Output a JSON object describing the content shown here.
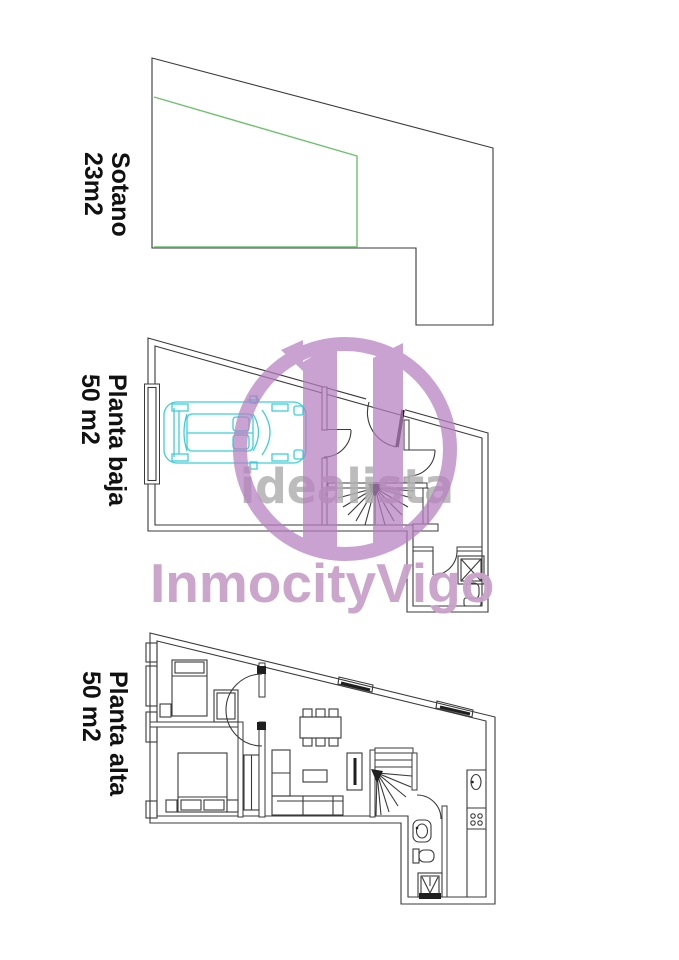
{
  "floors": [
    {
      "id": "sotano",
      "label_line1": "Sotano",
      "label_line2": "23m2"
    },
    {
      "id": "planta-baja",
      "label_line1": "Planta baja",
      "label_line2": "50 m2"
    },
    {
      "id": "planta-alta",
      "label_line1": "Planta alta",
      "label_line2": "50 m2"
    }
  ],
  "watermarks": {
    "logo_text": "idealista",
    "agency_text": "InmocityVigo"
  },
  "colors": {
    "wall": "#3a3a3a",
    "wall_dark": "#1f1f1f",
    "terrain_green": "#6cc26c",
    "car_cyan": "#3ccfda",
    "brand_magenta": "#b77fc0",
    "watermark_grey": "#b1b1b1",
    "agency_pink": "#c9a1ca"
  }
}
